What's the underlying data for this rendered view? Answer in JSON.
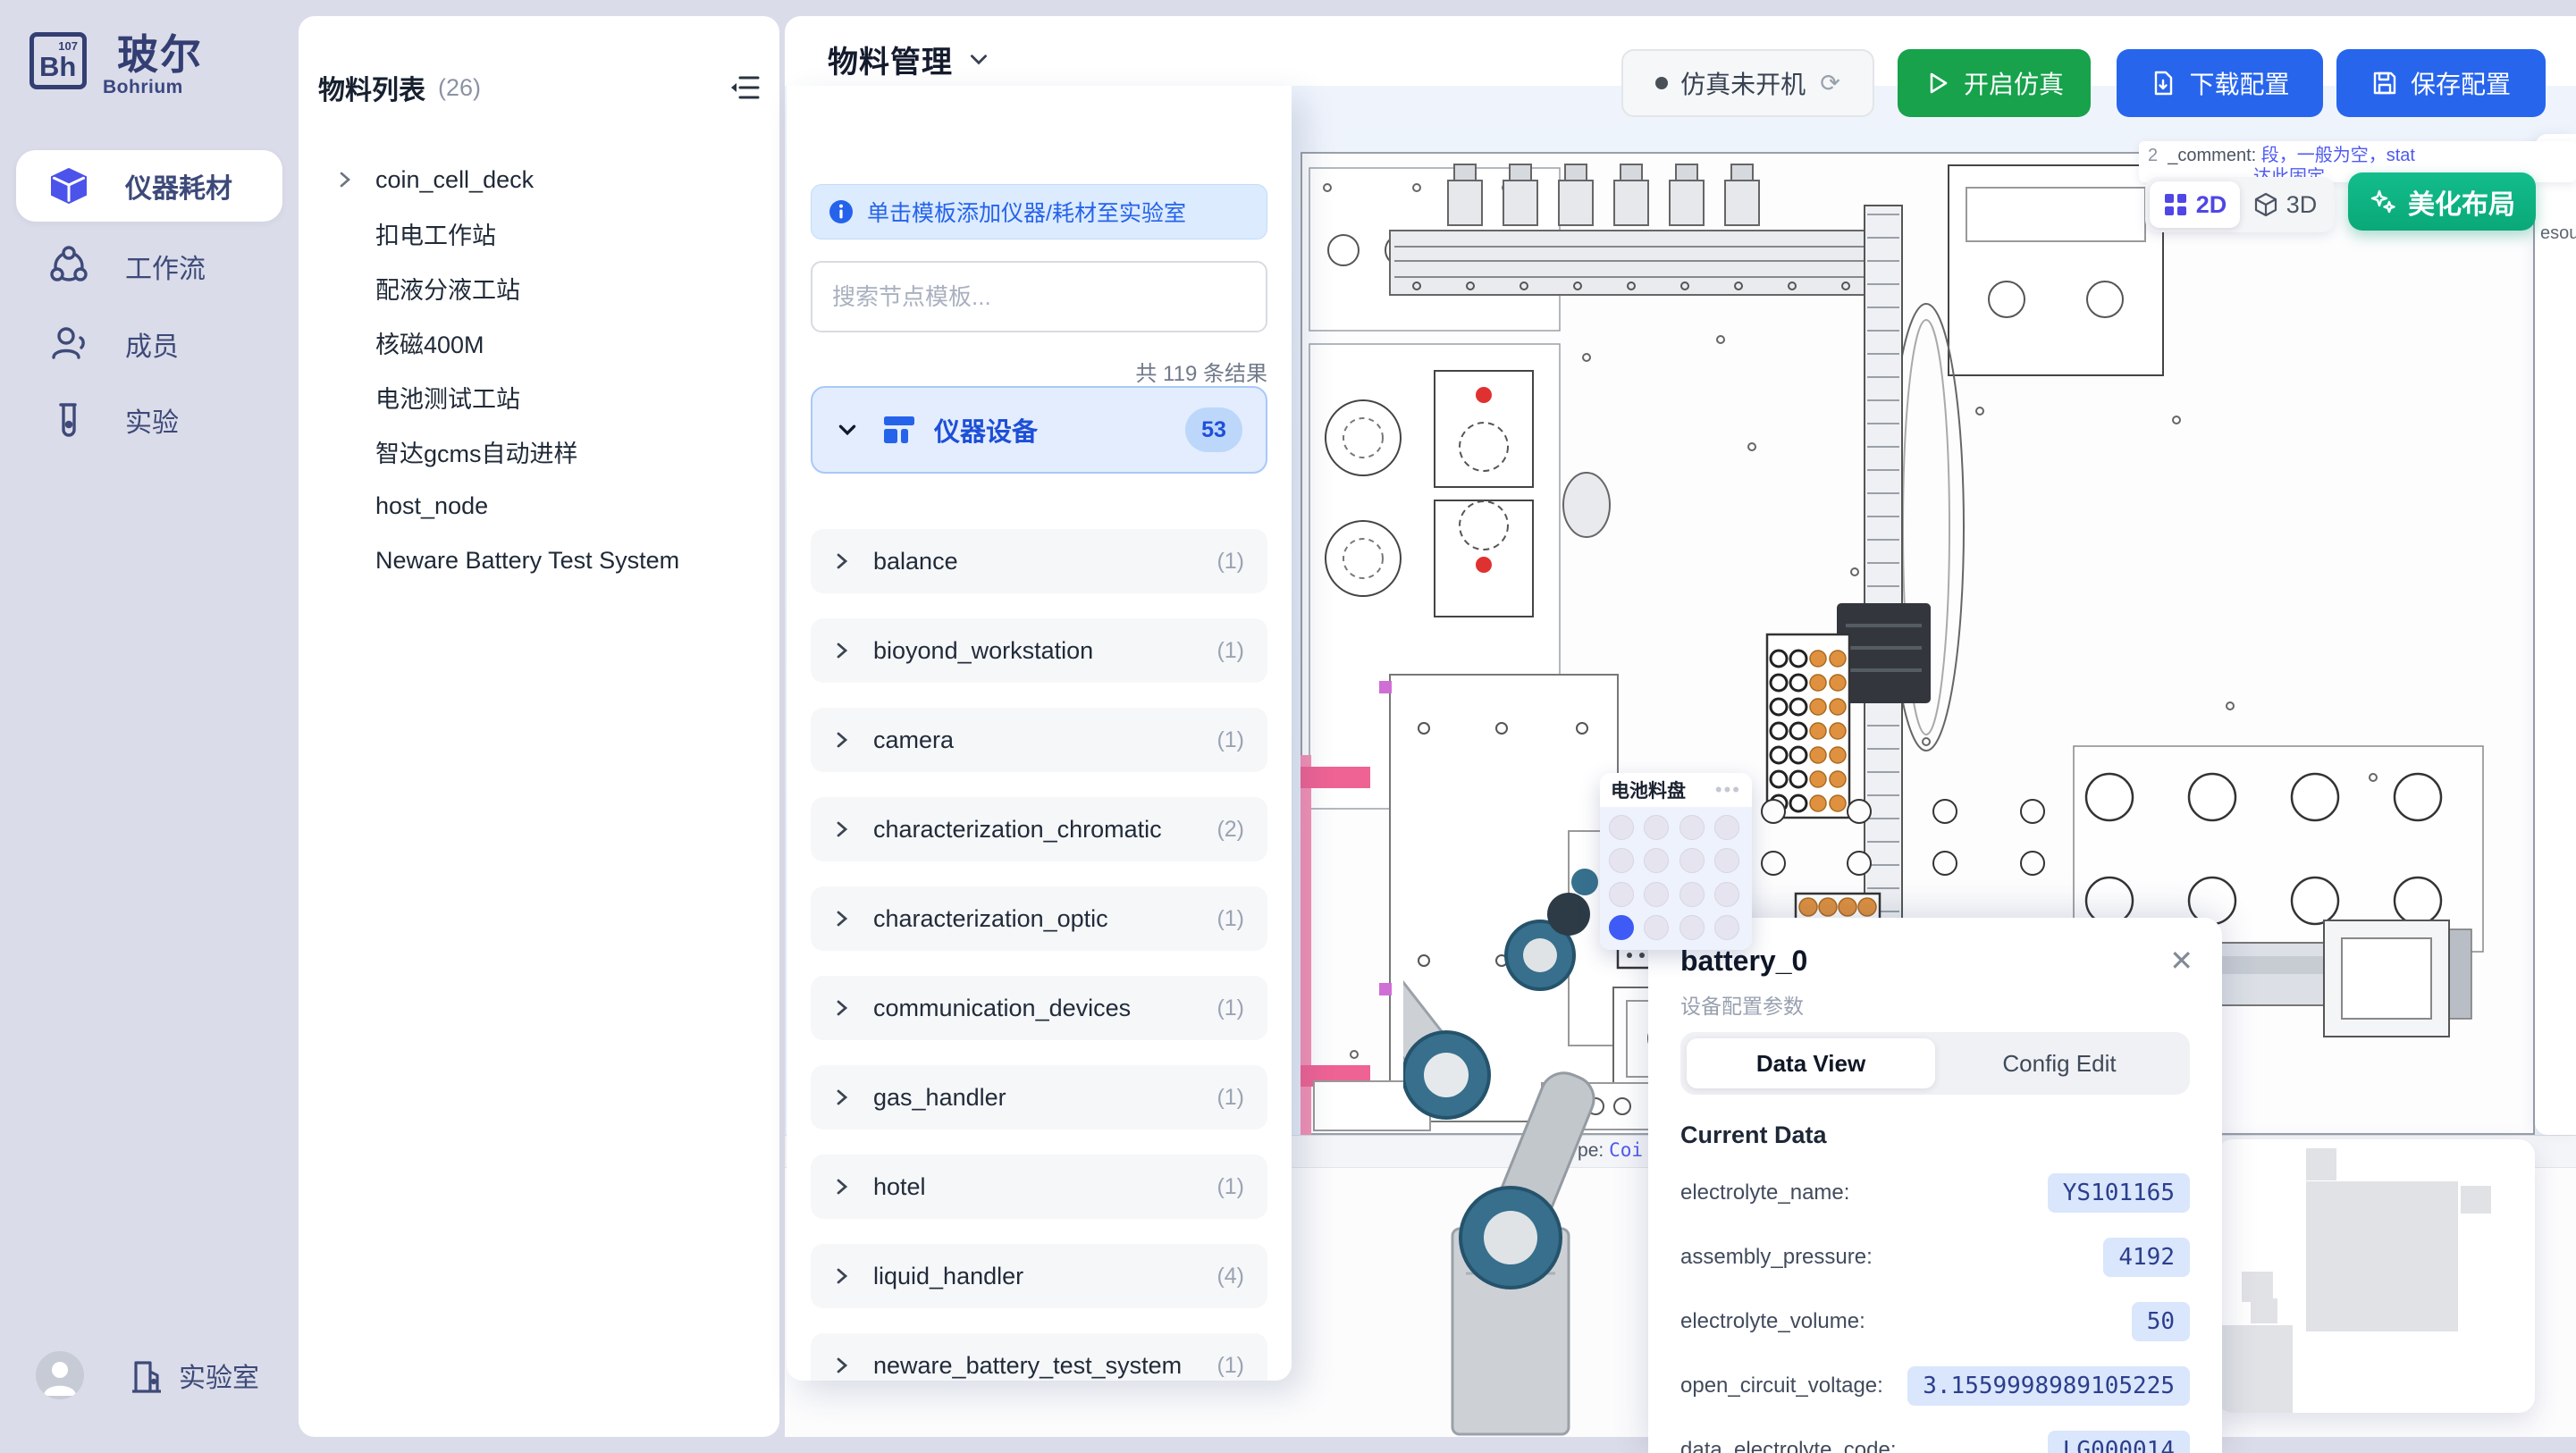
{
  "sidebar": {
    "logo_symbol": "Bh",
    "logo_number": "107",
    "logo_title": "玻尔",
    "logo_subtitle": "Bohrium",
    "items": [
      {
        "label": "仪器耗材",
        "active": true
      },
      {
        "label": "工作流"
      },
      {
        "label": "成员"
      },
      {
        "label": "实验"
      }
    ],
    "footer_label": "实验室"
  },
  "materials": {
    "title": "物料列表",
    "count": "(26)",
    "items": [
      "coin_cell_deck",
      "扣电工作站",
      "配液分液工站",
      "核磁400M",
      "电池测试工站",
      "智达gcms自动进样",
      "host_node",
      "Neware Battery Test System"
    ]
  },
  "header": {
    "title": "物料管理",
    "sim_status": "仿真未开机",
    "start_button": "开启仿真",
    "download_button": "下载配置",
    "save_button": "保存配置"
  },
  "template_panel": {
    "banner": "单击模板添加仪器/耗材至实验室",
    "search_placeholder": "搜索节点模板...",
    "result_count": "共 119 条结果",
    "category": {
      "label": "仪器设备",
      "count": "53"
    },
    "items": [
      {
        "label": "balance",
        "count": "(1)"
      },
      {
        "label": "bioyond_workstation",
        "count": "(1)"
      },
      {
        "label": "camera",
        "count": "(1)"
      },
      {
        "label": "characterization_chromatic",
        "count": "(2)"
      },
      {
        "label": "characterization_optic",
        "count": "(1)"
      },
      {
        "label": "communication_devices",
        "count": "(1)"
      },
      {
        "label": "gas_handler",
        "count": "(1)"
      },
      {
        "label": "hotel",
        "count": "(1)"
      },
      {
        "label": "liquid_handler",
        "count": "(4)"
      },
      {
        "label": "neware_battery_test_system",
        "count": "(1)"
      }
    ]
  },
  "canvas": {
    "comment_prefix": "2",
    "comment_key": "_comment:",
    "comment_value": "段，一般为空，stat",
    "comment_line2": "达此固定",
    "toggle_2d": "2D",
    "toggle_3d": "3D",
    "beautify_button": "美化布局",
    "tray_popup_title": "电池料盘",
    "tray_dots": "•••",
    "plate_fragment": "late",
    "type_fragment_label": "type:",
    "type_fragment_value": "Coi",
    "resources_fragment": "esou"
  },
  "battery_panel": {
    "title": "battery_0",
    "subtitle": "设备配置参数",
    "tabs": [
      {
        "label": "Data View",
        "active": true
      },
      {
        "label": "Config Edit"
      }
    ],
    "section_title": "Current Data",
    "rows": [
      {
        "key": "electrolyte_name:",
        "value": "YS101165"
      },
      {
        "key": "assembly_pressure:",
        "value": "4192"
      },
      {
        "key": "electrolyte_volume:",
        "value": "50"
      },
      {
        "key": "open_circuit_voltage:",
        "value": "3.1559998989105225"
      },
      {
        "key": "data_electrolyte_code:",
        "value": "LG000014"
      }
    ]
  },
  "colors": {
    "accent_blue": "#2765ed",
    "accent_green": "#17a24b",
    "accent_teal": "#0fb584",
    "accent_indigo": "#4f46e5",
    "selected_blue": "#1d4fd7",
    "sidebar_navy": "#3d4a79"
  }
}
